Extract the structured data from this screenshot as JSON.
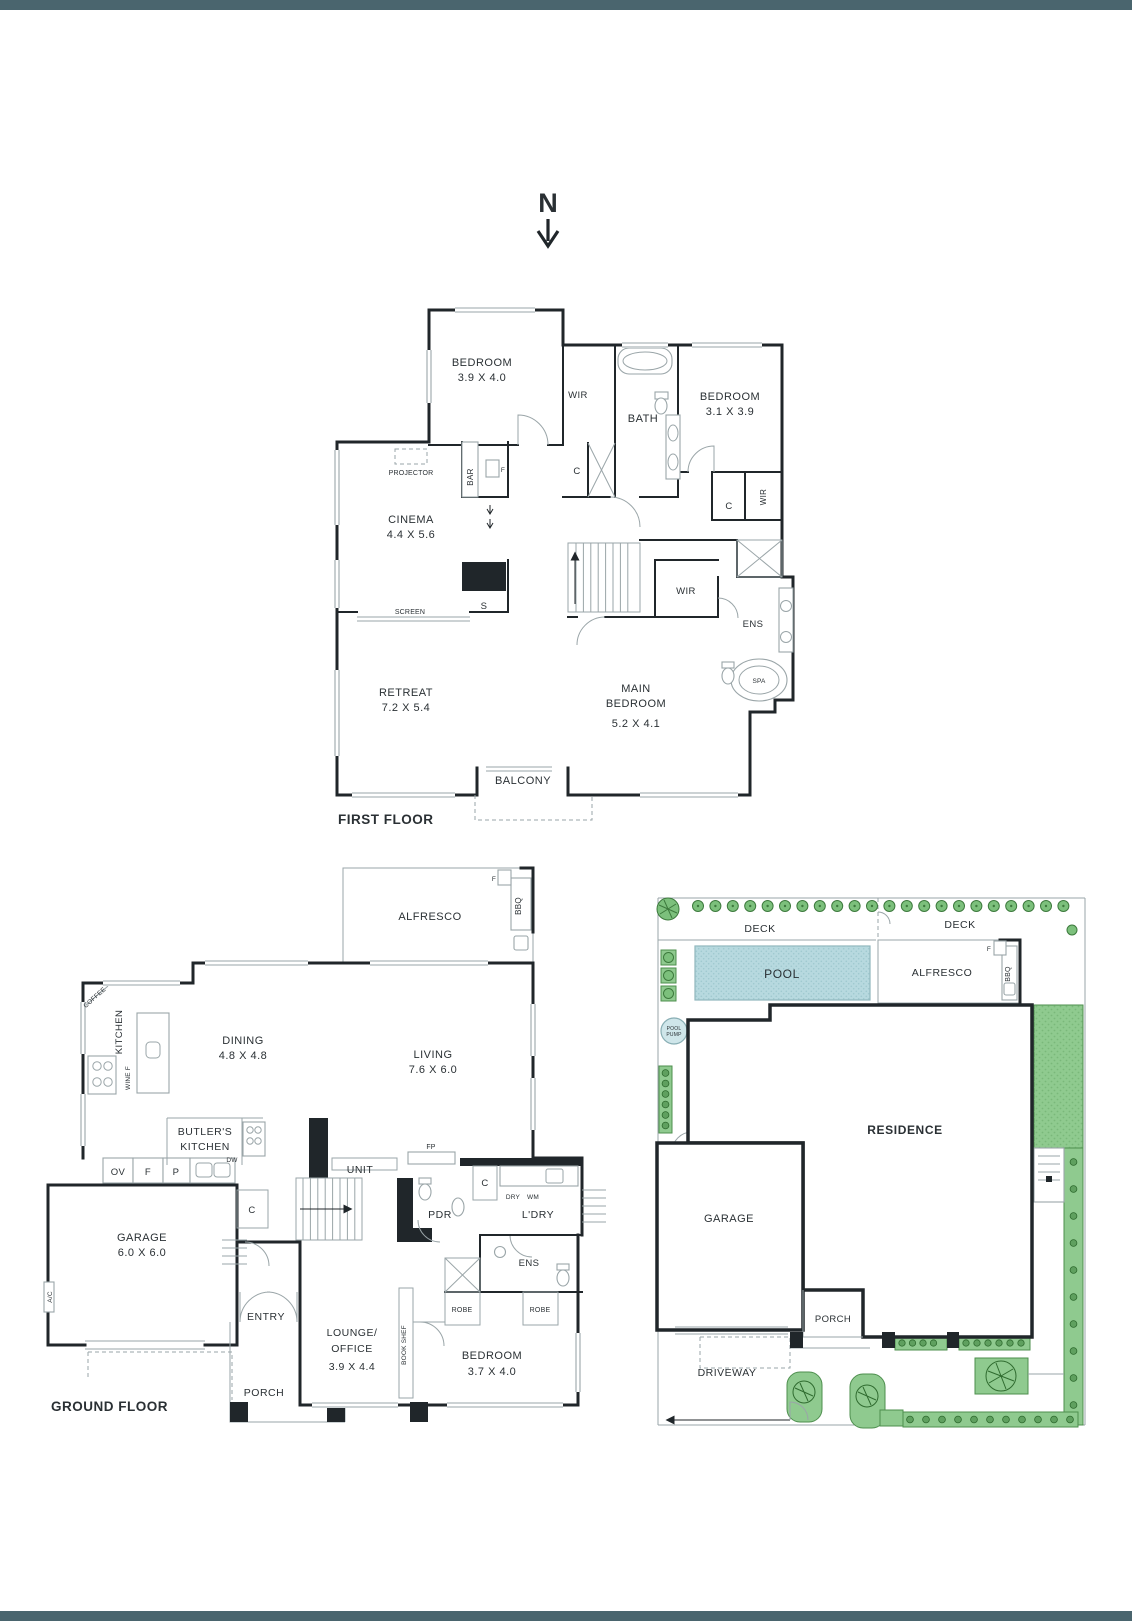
{
  "colors": {
    "bar": "#4a656e",
    "wall": "#20262a",
    "line": "#9aa5a8",
    "pool": "#b7d9df",
    "green": "#8fca8f",
    "green_dark": "#4e8f4e"
  },
  "north": {
    "label": "N"
  },
  "ff": {
    "title": "FIRST FLOOR",
    "bedroom1": "BEDROOM",
    "bedroom1_dims": "3.9 X 4.0",
    "wir1": "WIR",
    "bath": "BATH",
    "bedroom2": "BEDROOM",
    "bedroom2_dims": "3.1 X 3.9",
    "projector": "PROJECTOR",
    "bar": "BAR",
    "bar_f": "F",
    "c_hall": "C",
    "cinema": "CINEMA",
    "cinema_dims": "4.4 X 5.6",
    "c_bed2": "C",
    "wir_bed2": "WIR",
    "wir_main": "WIR",
    "s": "S",
    "screen": "SCREEN",
    "ens": "ENS",
    "spa": "SPA",
    "retreat": "RETREAT",
    "retreat_dims": "7.2 X 5.4",
    "main_line1": "MAIN",
    "main_line2": "BEDROOM",
    "main_dims": "5.2 X 4.1",
    "balcony": "BALCONY"
  },
  "gf": {
    "title": "GROUND FLOOR",
    "alfresco": "ALFRESCO",
    "f_alfresco": "F",
    "bbq": "BBQ",
    "coffee": "COFFEE",
    "kitchen": "KITCHEN",
    "wine_f": "WINE F",
    "dining": "DINING",
    "dining_dims": "4.8 X 4.8",
    "living": "LIVING",
    "living_dims": "7.6 X 6.0",
    "butlers_line1": "BUTLER'S",
    "butlers_line2": "KITCHEN",
    "dw": "DW",
    "ov": "OV",
    "f_kitchen": "F",
    "p": "P",
    "c_pantry": "C",
    "unit": "UNIT",
    "fp": "FP",
    "c_laundry": "C",
    "dry": "DRY",
    "wm": "WM",
    "ldry": "L'DRY",
    "pdr": "PDR",
    "garage": "GARAGE",
    "garage_dims": "6.0 X 6.0",
    "ac": "A/C",
    "entry": "ENTRY",
    "porch": "PORCH",
    "lounge_line1": "LOUNGE/",
    "lounge_line2": "OFFICE",
    "lounge_dims": "3.9 X 4.4",
    "bookshelf": "BOOK SHEF",
    "bedroom": "BEDROOM",
    "bedroom_dims": "3.7 X 4.0",
    "robe1": "ROBE",
    "robe2": "ROBE",
    "ens": "ENS"
  },
  "site": {
    "deck_left": "DECK",
    "deck_right": "DECK",
    "pool": "POOL",
    "alfresco": "ALFRESCO",
    "f": "F",
    "bbq": "BBQ",
    "pool_pump_line1": "POOL",
    "pool_pump_line2": "PUMP",
    "residence": "RESIDENCE",
    "garage": "GARAGE",
    "porch": "PORCH",
    "driveway": "DRIVEWAY"
  }
}
